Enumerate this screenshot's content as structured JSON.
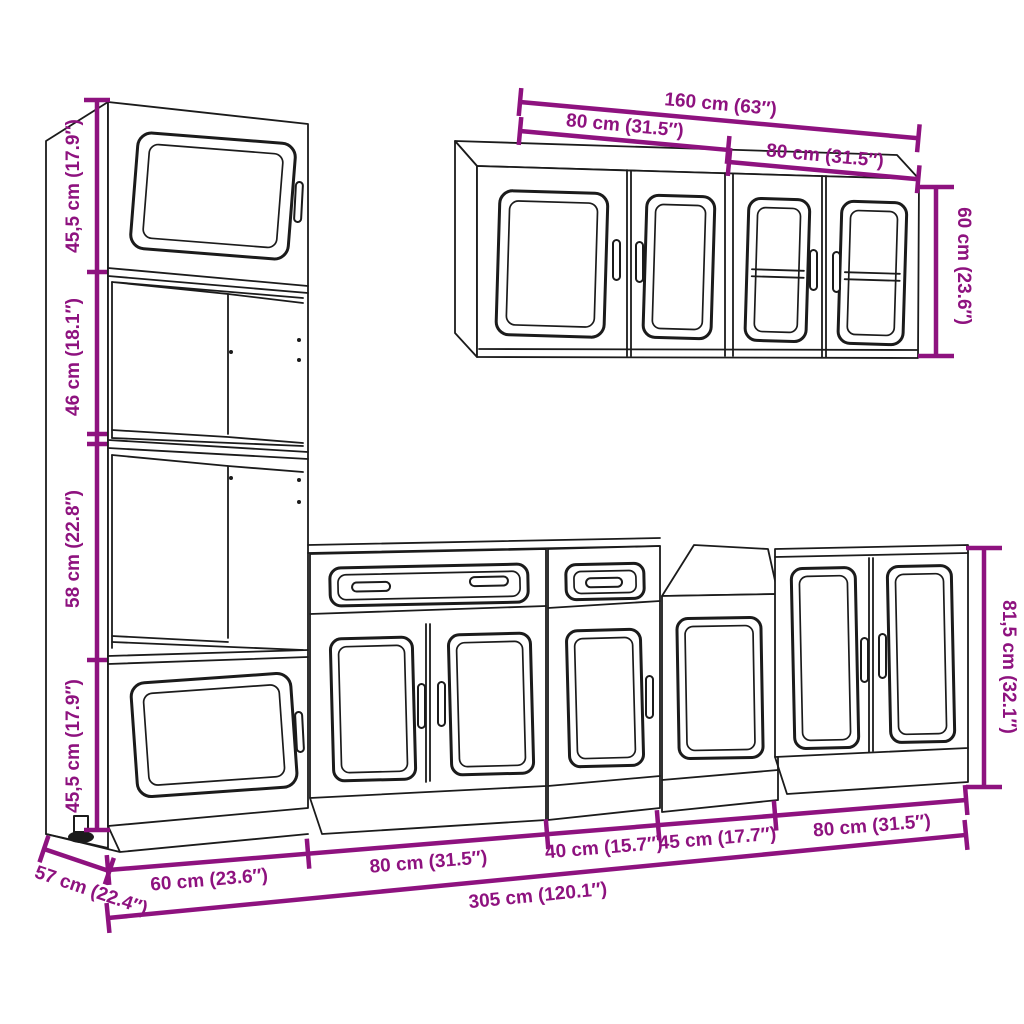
{
  "colors": {
    "dimension": "#8E127F",
    "outline": "#1b1b1b",
    "background": "#ffffff"
  },
  "tall_cabinet_heights": {
    "top_section": "45,5 cm (17.9″)",
    "upper_middle_section": "46 cm (18.1″)",
    "lower_middle_section": "58 cm (22.8″)",
    "bottom_section": "45,5 cm (17.9″)"
  },
  "wall_cabinets": {
    "total_width": "160 cm (63″)",
    "left_cabinet_width": "80 cm (31.5″)",
    "right_cabinet_width": "80 cm (31.5″)",
    "height": "60 cm (23.6″)"
  },
  "base_cabinets": {
    "widths": [
      "60 cm (23.6″)",
      "80 cm (31.5″)",
      "40 cm (15.7″)",
      "45 cm (17.7″)",
      "80 cm (31.5″)"
    ],
    "total_width": "305 cm (120.1″)",
    "depth": "57 cm (22.4″)",
    "tall_unit_height": "81,5 cm (32.1″)"
  }
}
